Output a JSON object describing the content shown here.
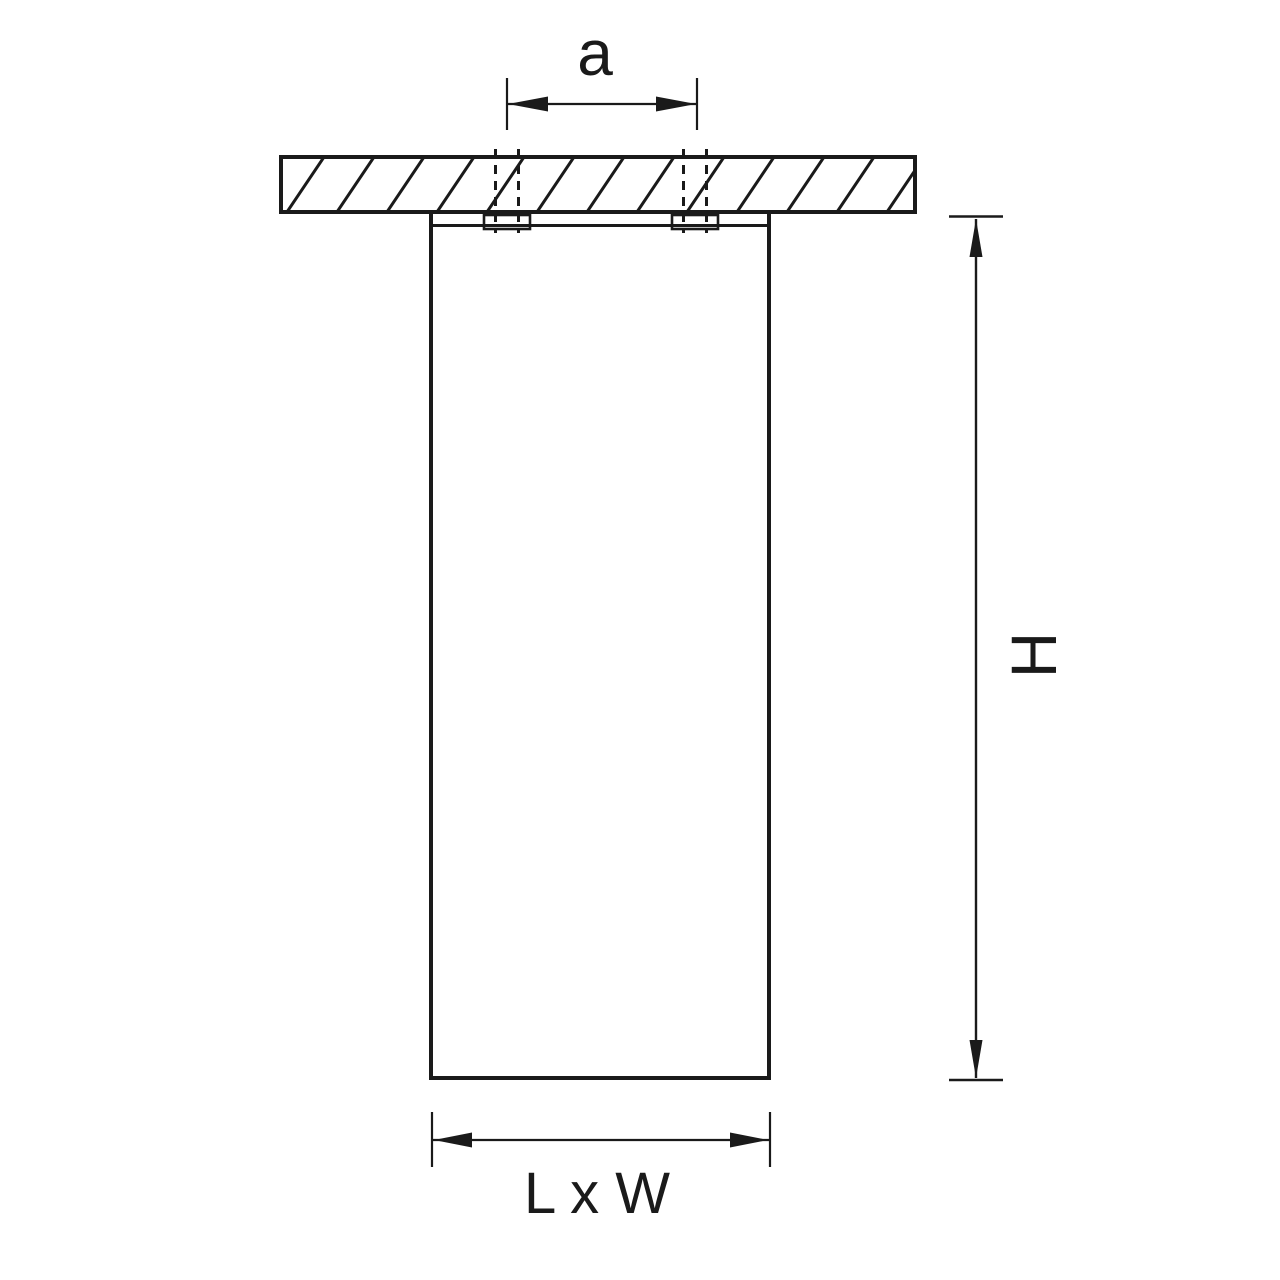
{
  "drawing": {
    "labels": {
      "hole_spacing": "a",
      "height": "H",
      "base": "L x W"
    },
    "colors": {
      "line": "#1a1a1a",
      "background": "#ffffff"
    }
  }
}
